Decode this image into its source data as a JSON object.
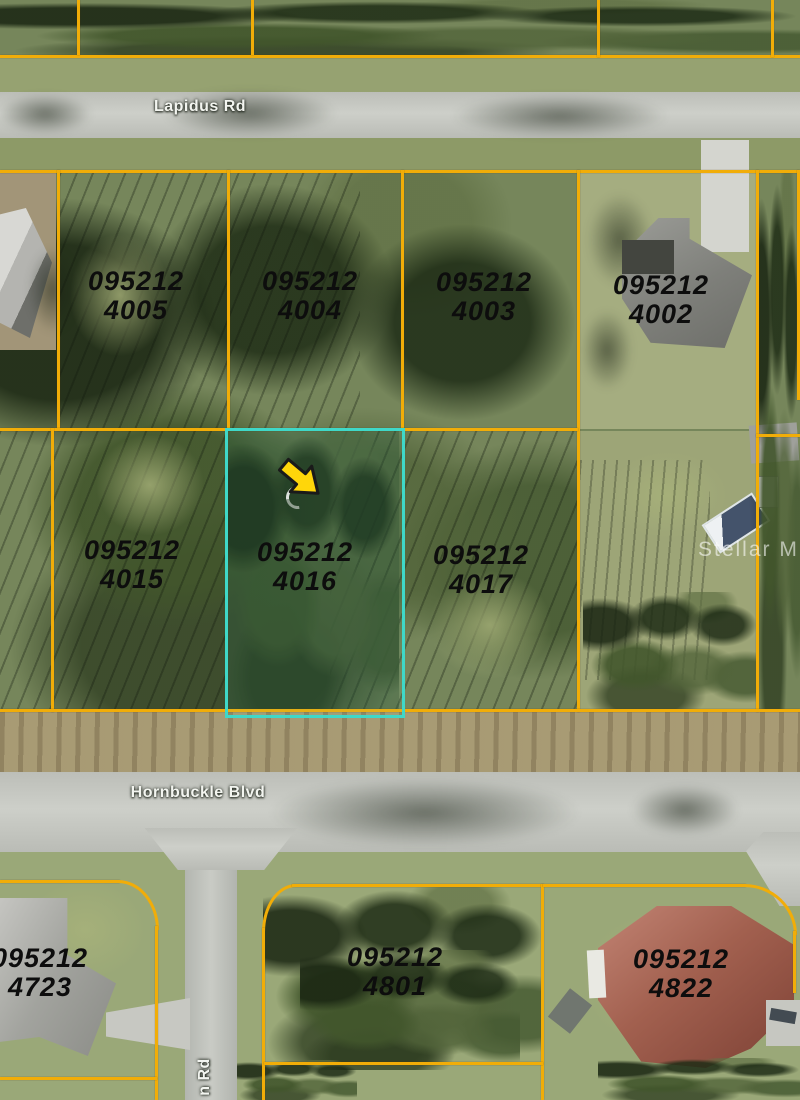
{
  "map": {
    "roads": {
      "lapidus": "Lapidus Rd",
      "hornbuckle": "Hornbuckle Blvd",
      "side_road_partial": "n Rd"
    },
    "watermark": "Stellar MLS",
    "colors": {
      "boundary": "#f1ad08",
      "highlight": "#3fd8c8",
      "arrow": "#ffd60a"
    },
    "dim_labels": [
      {
        "t": "80'",
        "x": 163,
        "y": 42
      },
      {
        "t": "160'",
        "x": 419,
        "y": 25
      },
      {
        "t": "80'",
        "x": 331,
        "y": 44
      },
      {
        "t": "80'",
        "x": 507,
        "y": 46
      },
      {
        "t": "80'",
        "x": 682,
        "y": 47
      },
      {
        "t": "80'",
        "x": 142,
        "y": 184
      },
      {
        "t": "80'",
        "x": 313,
        "y": 184
      },
      {
        "t": "83'",
        "x": 486,
        "y": 189
      },
      {
        "t": "83'",
        "x": 663,
        "y": 191
      },
      {
        "t": "125'",
        "x": 48,
        "y": 302,
        "r": 1
      },
      {
        "t": "125'",
        "x": 217,
        "y": 302,
        "r": 1
      },
      {
        "t": "125'",
        "x": 390,
        "y": 302,
        "r": 1
      },
      {
        "t": "125'",
        "x": 567,
        "y": 302,
        "r": 1
      },
      {
        "t": "125'",
        "x": 748,
        "y": 301,
        "r": 1
      },
      {
        "t": "80'",
        "x": 137,
        "y": 419
      },
      {
        "t": "80'",
        "x": 310,
        "y": 424
      },
      {
        "t": "83'",
        "x": 483,
        "y": 423
      },
      {
        "t": "250'",
        "x": 591,
        "y": 431,
        "r": 1
      },
      {
        "t": "250'",
        "x": 735,
        "y": 437,
        "r": 1
      },
      {
        "t": "125'",
        "x": 43,
        "y": 570,
        "r": 1
      },
      {
        "t": "125'",
        "x": 215,
        "y": 574,
        "r": 1
      },
      {
        "t": "125'",
        "x": 383,
        "y": 572,
        "r": 1
      },
      {
        "t": "125'",
        "x": 565,
        "y": 577,
        "r": 1
      },
      {
        "t": "125'",
        "x": 742,
        "y": 579,
        "r": 1
      },
      {
        "t": "80'",
        "x": 135,
        "y": 692
      },
      {
        "t": "80'",
        "x": 308,
        "y": 694
      },
      {
        "t": "83'",
        "x": 483,
        "y": 696
      },
      {
        "t": "83'",
        "x": 663,
        "y": 697
      },
      {
        "t": "125'",
        "x": 22,
        "y": 892
      },
      {
        "t": "50'",
        "x": 203,
        "y": 897
      },
      {
        "t": "125'",
        "x": 397,
        "y": 901
      },
      {
        "t": "125'",
        "x": 662,
        "y": 904
      },
      {
        "t": "94.05'",
        "x": 143,
        "y": 976,
        "r": 1
      },
      {
        "t": "85'",
        "x": 282,
        "y": 967,
        "r": 1
      },
      {
        "t": "85'",
        "x": 788,
        "y": 969,
        "r": 1
      },
      {
        "t": "125'",
        "x": 22,
        "y": 1067
      },
      {
        "t": "125'",
        "x": 400,
        "y": 1054
      },
      {
        "t": "165'",
        "x": 552,
        "y": 1061,
        "r": 1
      },
      {
        "t": "165'",
        "x": 759,
        "y": 1066,
        "r": 1
      }
    ],
    "parcels": [
      {
        "line1": "095212",
        "line2": "4005",
        "x": 136,
        "y": 296
      },
      {
        "line1": "095212",
        "line2": "4004",
        "x": 310,
        "y": 296
      },
      {
        "line1": "095212",
        "line2": "4003",
        "x": 484,
        "y": 297
      },
      {
        "line1": "095212",
        "line2": "4002",
        "x": 661,
        "y": 300
      },
      {
        "line1": "095212",
        "line2": "4015",
        "x": 132,
        "y": 565
      },
      {
        "line1": "095212",
        "line2": "4016",
        "x": 305,
        "y": 567
      },
      {
        "line1": "095212",
        "line2": "4017",
        "x": 481,
        "y": 570
      },
      {
        "line1": "095212",
        "line2": "4723",
        "x": 40,
        "y": 973
      },
      {
        "line1": "095212",
        "line2": "4801",
        "x": 395,
        "y": 972
      },
      {
        "line1": "095212",
        "line2": "4822",
        "x": 681,
        "y": 974
      }
    ],
    "lot_numbers": [
      {
        "t": "5",
        "x": 140,
        "y": 372
      },
      {
        "t": "4",
        "x": 312,
        "y": 372
      },
      {
        "t": "3",
        "x": 486,
        "y": 377
      },
      {
        "t": "2",
        "x": 663,
        "y": 378
      },
      {
        "t": "15",
        "x": 132,
        "y": 485
      },
      {
        "t": "17",
        "x": 483,
        "y": 488
      },
      {
        "t": "18",
        "x": 658,
        "y": 491
      },
      {
        "t": "1",
        "x": 500,
        "y": 978
      },
      {
        "t": "22",
        "x": 582,
        "y": 980
      }
    ],
    "partial_texts": [
      {
        "t": "2",
        "x": 3,
        "y": 275
      },
      {
        "t": "2",
        "x": 3,
        "y": 548
      },
      {
        "t": "0",
        "x": 796,
        "y": 564
      },
      {
        "t": "4",
        "x": 797,
        "y": 194
      }
    ]
  }
}
